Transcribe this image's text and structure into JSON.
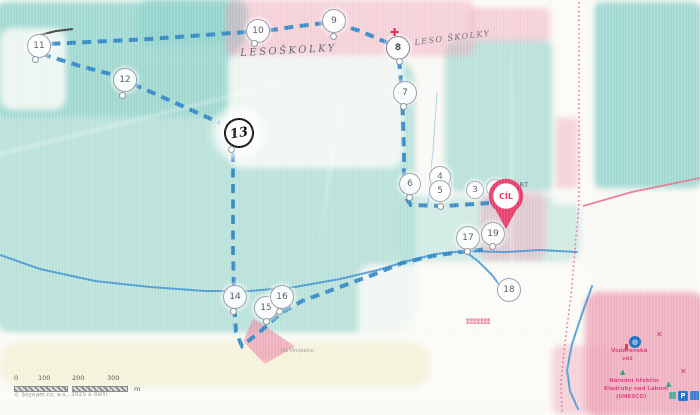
{
  "photo": {
    "copyright": "© Seznam.cz, a.s., 2025 a další"
  },
  "scalebar": {
    "ticks": [
      {
        "label": "0",
        "x": 0
      },
      {
        "label": "100",
        "x": 24
      },
      {
        "label": "200",
        "x": 58
      },
      {
        "label": "300",
        "x": 93
      }
    ],
    "unit": "m"
  },
  "course": {
    "start_label": "START",
    "finish_label": "CÍL",
    "route_color": "#2e86c6",
    "finish_color": "#e8416f",
    "controls": [
      {
        "id": "2",
        "x": 494,
        "y": 187,
        "r": 8,
        "cls": "small"
      },
      {
        "id": "3",
        "x": 474,
        "y": 189,
        "r": 8,
        "cls": "small"
      },
      {
        "id": "4",
        "x": 439,
        "y": 176,
        "r": 10
      },
      {
        "id": "5",
        "x": 439,
        "y": 190,
        "r": 10,
        "dotx": 440,
        "doty": 206
      },
      {
        "id": "6",
        "x": 409,
        "y": 183,
        "r": 10,
        "dotx": 409,
        "doty": 197
      },
      {
        "id": "7",
        "x": 404,
        "y": 92,
        "r": 11,
        "dotx": 403,
        "doty": 106
      },
      {
        "id": "8",
        "x": 397,
        "y": 47,
        "r": 11,
        "cls": "bold",
        "dotx": 399,
        "doty": 61
      },
      {
        "id": "9",
        "x": 333,
        "y": 20,
        "r": 11,
        "dotx": 333,
        "doty": 36
      },
      {
        "id": "10",
        "x": 257,
        "y": 30,
        "r": 11,
        "dotx": 254,
        "doty": 43
      },
      {
        "id": "11",
        "x": 38,
        "y": 45,
        "r": 11,
        "dotx": 35,
        "doty": 59
      },
      {
        "id": "12",
        "x": 124,
        "y": 79,
        "r": 11,
        "dotx": 122,
        "doty": 95
      },
      {
        "id": "13",
        "x": 237,
        "y": 131,
        "r": 13,
        "cls": "hand",
        "dotx": 231,
        "doty": 149
      },
      {
        "id": "14",
        "x": 234,
        "y": 296,
        "r": 11,
        "dotx": 233,
        "doty": 311
      },
      {
        "id": "15",
        "x": 265,
        "y": 307,
        "r": 11,
        "dotx": 266,
        "doty": 321
      },
      {
        "id": "16",
        "x": 281,
        "y": 296,
        "r": 11,
        "dotx": 279,
        "doty": 311
      },
      {
        "id": "17",
        "x": 467,
        "y": 237,
        "r": 11,
        "dotx": 467,
        "doty": 251
      },
      {
        "id": "18",
        "x": 508,
        "y": 289,
        "r": 11
      },
      {
        "id": "19",
        "x": 492,
        "y": 233,
        "r": 11,
        "dotx": 492,
        "doty": 246
      }
    ]
  },
  "lines": {
    "route": [
      {
        "pts": [
          [
            399,
            60
          ],
          [
            402,
            92
          ],
          [
            404,
            150
          ],
          [
            404,
            195
          ],
          [
            411,
            205
          ],
          [
            445,
            206
          ],
          [
            489,
            203
          ]
        ]
      },
      {
        "pts": [
          [
            388,
            43
          ],
          [
            360,
            31
          ],
          [
            341,
            25
          ]
        ]
      },
      {
        "pts": [
          [
            324,
            23
          ],
          [
            292,
            27
          ],
          [
            265,
            31
          ]
        ]
      },
      {
        "pts": [
          [
            246,
            32
          ],
          [
            150,
            39
          ],
          [
            48,
            44
          ]
        ]
      },
      {
        "pts": [
          [
            42,
            54
          ],
          [
            80,
            66
          ],
          [
            114,
            75
          ]
        ]
      },
      {
        "pts": [
          [
            133,
            84
          ],
          [
            180,
            105
          ],
          [
            220,
            123
          ]
        ]
      },
      {
        "pts": [
          [
            233,
            153
          ],
          [
            233,
            250
          ],
          [
            234,
            300
          ],
          [
            236,
            332
          ],
          [
            242,
            346
          ],
          [
            262,
            330
          ],
          [
            281,
            313
          ],
          [
            302,
            301
          ],
          [
            340,
            287
          ],
          [
            375,
            274
          ],
          [
            402,
            263
          ],
          [
            432,
            256
          ],
          [
            460,
            252
          ],
          [
            488,
            249
          ]
        ]
      }
    ],
    "streams": [
      {
        "pts": [
          [
            0,
            255
          ],
          [
            40,
            269
          ],
          [
            95,
            281
          ],
          [
            150,
            287
          ],
          [
            205,
            291
          ],
          [
            250,
            291
          ],
          [
            295,
            287
          ],
          [
            340,
            279
          ],
          [
            378,
            270
          ],
          [
            408,
            261
          ],
          [
            436,
            254
          ],
          [
            465,
            251
          ],
          [
            505,
            252
          ],
          [
            540,
            250
          ],
          [
            577,
            252
          ]
        ]
      },
      {
        "pts": [
          [
            466,
            252
          ],
          [
            479,
            262
          ],
          [
            492,
            275
          ],
          [
            501,
            287
          ],
          [
            505,
            296
          ]
        ]
      },
      {
        "pts": [
          [
            592,
            286
          ],
          [
            582,
            314
          ],
          [
            572,
            344
          ],
          [
            567,
            370
          ],
          [
            570,
            391
          ],
          [
            578,
            409
          ]
        ]
      },
      {
        "pts": [
          [
            437,
            92
          ],
          [
            433,
            150
          ],
          [
            428,
            204
          ]
        ],
        "faint": true
      }
    ],
    "roads_solid": [
      {
        "pts": [
          [
            583,
            206
          ],
          [
            632,
            192
          ],
          [
            700,
            178
          ]
        ]
      }
    ],
    "roads_dotted": [
      {
        "pts": [
          [
            579,
            2
          ],
          [
            579,
            204
          ]
        ]
      },
      {
        "pts": [
          [
            579,
            204
          ],
          [
            575,
            250
          ],
          [
            571,
            296
          ],
          [
            565,
            342
          ],
          [
            561,
            382
          ],
          [
            562,
            413
          ]
        ]
      }
    ]
  },
  "labels": [
    {
      "text": "LESOŠKOLKY",
      "x": 240,
      "y": 48,
      "cls": "hand",
      "rot": -3
    },
    {
      "text": "LESO ŠKOLKY",
      "x": 414,
      "y": 38,
      "cls": "hand2",
      "rot": -7
    },
    {
      "text": "START",
      "x": 506,
      "y": 181,
      "cls": "start",
      "rot": 0
    },
    {
      "text": "Vodárenská",
      "x": 611,
      "y": 348,
      "cls": "place",
      "rot": 0
    },
    {
      "text": "věž",
      "x": 622,
      "y": 356,
      "cls": "place",
      "rot": 0
    },
    {
      "text": "Národní hřebčín",
      "x": 609,
      "y": 378,
      "cls": "place",
      "rot": 0
    },
    {
      "text": "Kladruby nad Labem",
      "x": 604,
      "y": 386,
      "cls": "place",
      "rot": 0
    },
    {
      "text": "(UNESCO)",
      "x": 616,
      "y": 394,
      "cls": "place",
      "rot": 0
    },
    {
      "text": "Na Vinopalce",
      "x": 281,
      "y": 348,
      "cls": "faint",
      "rot": 0
    }
  ],
  "icons": [
    {
      "name": "first-aid-cross-icon",
      "type": "cross-red",
      "x": 390,
      "y": 27,
      "glyph": "✚"
    },
    {
      "name": "poi-circle-icon",
      "type": "poi-circle",
      "x": 629,
      "y": 336,
      "glyph": "◍"
    },
    {
      "name": "mill-cross-icon",
      "type": "x-mark",
      "x": 656,
      "y": 331,
      "glyph": "✕"
    },
    {
      "name": "mill-cross-icon",
      "type": "x-mark",
      "x": 680,
      "y": 368,
      "glyph": "✕"
    },
    {
      "name": "tree-icon",
      "type": "tree",
      "x": 620,
      "y": 369,
      "glyph": "▲"
    },
    {
      "name": "tree-icon",
      "type": "tree",
      "x": 666,
      "y": 381,
      "glyph": "▲"
    },
    {
      "name": "parking-icon",
      "type": "parking",
      "x": 678,
      "y": 391,
      "glyph": "P"
    },
    {
      "name": "info-square-icon",
      "type": "square-blue",
      "x": 690,
      "y": 391,
      "glyph": ""
    },
    {
      "name": "poi-square-icon",
      "type": "square-teal",
      "x": 669,
      "y": 392,
      "glyph": ""
    },
    {
      "name": "flag-icon",
      "type": "flag",
      "x": 625,
      "y": 344,
      "glyph": ""
    }
  ],
  "colors": {
    "forest_teal": "#a3dad2",
    "urban_pink": "#eea8bc",
    "route_blue": "#2e86c6",
    "water_blue": "#3e92d2",
    "boundary_magenta": "#e75b9e"
  }
}
